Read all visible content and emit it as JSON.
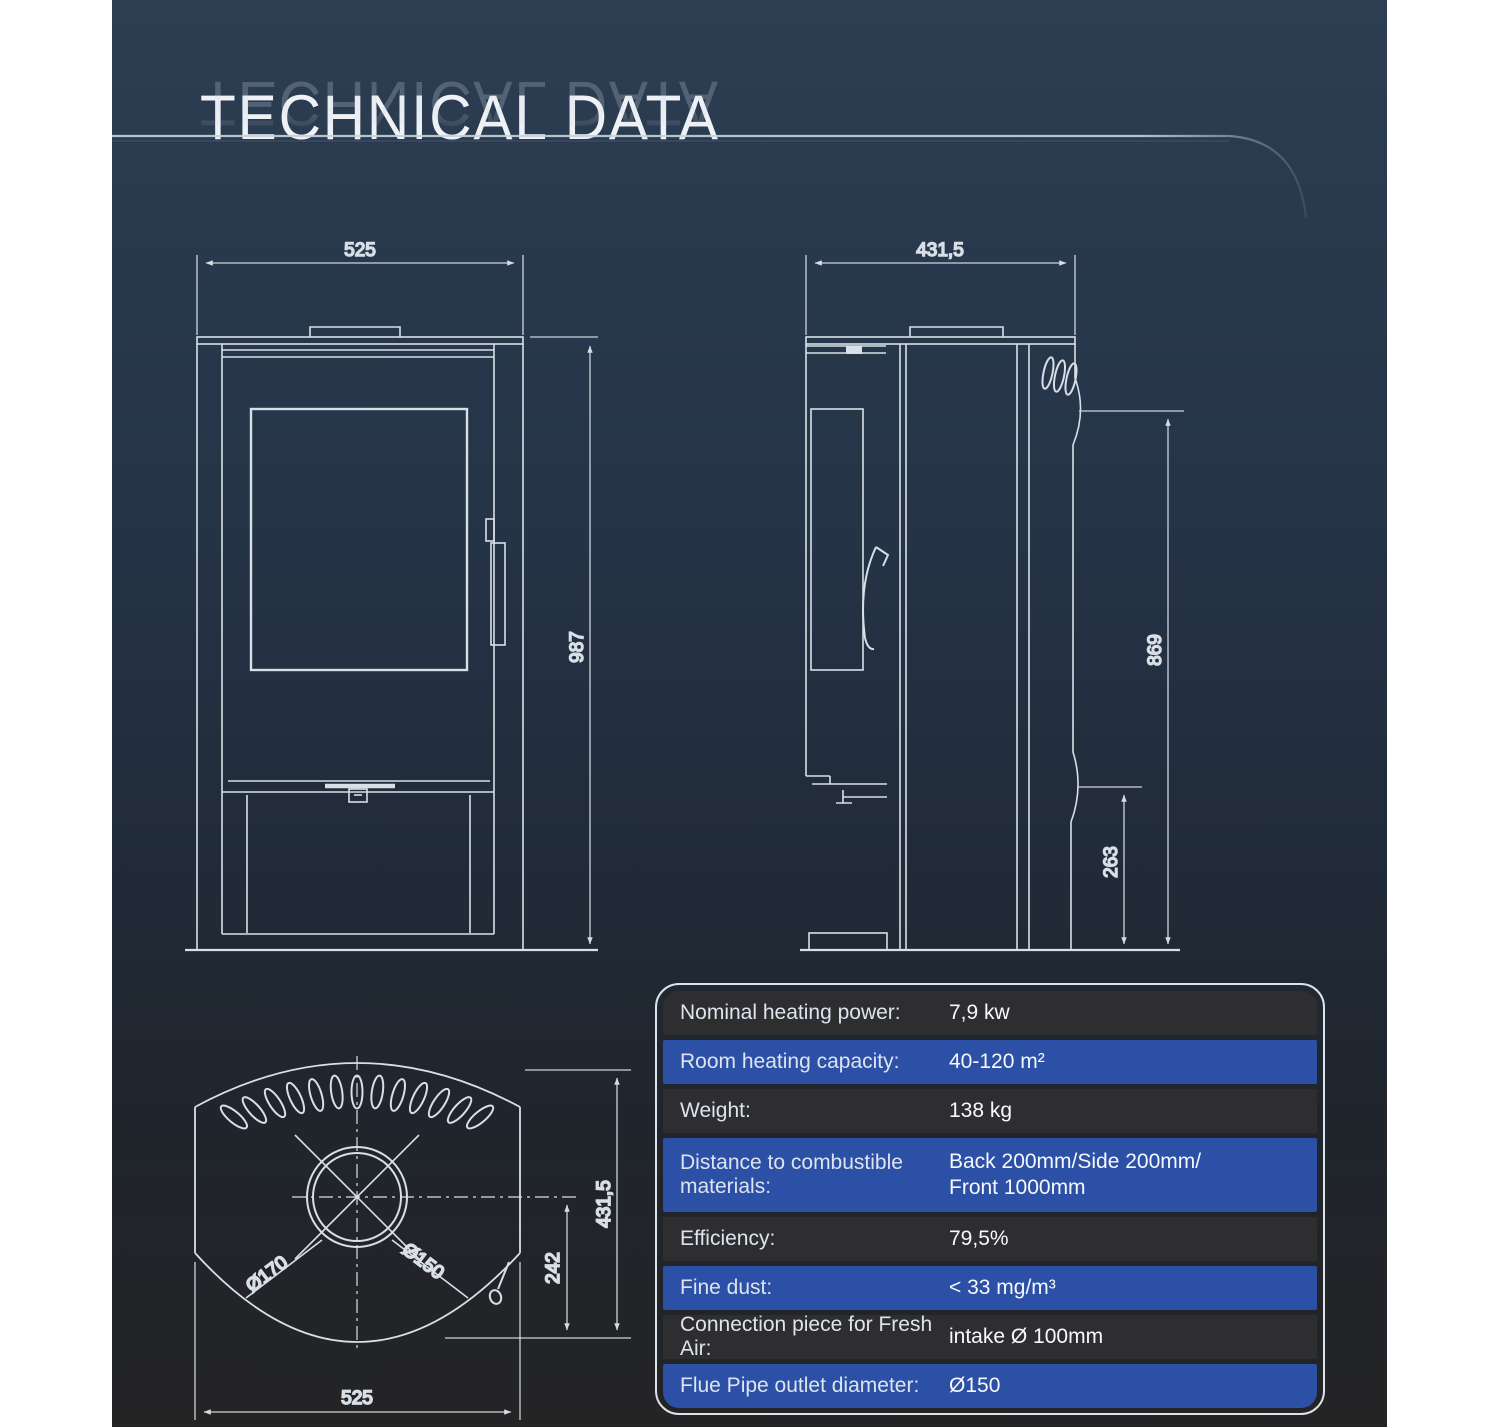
{
  "page": {
    "title": "TECHNICAL DATA"
  },
  "front_view": {
    "width_label": "525",
    "height_label": "987"
  },
  "side_view": {
    "depth_label": "431,5",
    "flue_outlet_height_label": "869",
    "air_intake_height_label": "263"
  },
  "top_view": {
    "outer_diameter_label": "Ø170",
    "inner_diameter_label": "Ø150",
    "center_to_back_label": "242",
    "depth_label": "431,5",
    "width_label": "525"
  },
  "table": {
    "rows": [
      {
        "label": "Nominal heating power:",
        "value": "7,9 kw"
      },
      {
        "label": "Room heating capacity:",
        "value": "40-120 m²"
      },
      {
        "label": "Weight:",
        "value": "138 kg"
      },
      {
        "label": "Distance to combustible materials:",
        "value": "Back 200mm/Side 200mm/",
        "value2": "Front 1000mm"
      },
      {
        "label": "Efficiency:",
        "value": "79,5%"
      },
      {
        "label": "Fine dust:",
        "value": "< 33 mg/m³"
      },
      {
        "label": "Connection piece for Fresh Air:",
        "value": "intake Ø 100mm"
      },
      {
        "label": "Flue Pipe outlet diameter:",
        "value": "Ø150"
      }
    ]
  },
  "colors": {
    "row_blue": "#2b50a6",
    "row_dark": "#2e2e30",
    "background_top": "#2d3e53",
    "background_bottom": "#242425",
    "line": "#d9dfe6"
  }
}
